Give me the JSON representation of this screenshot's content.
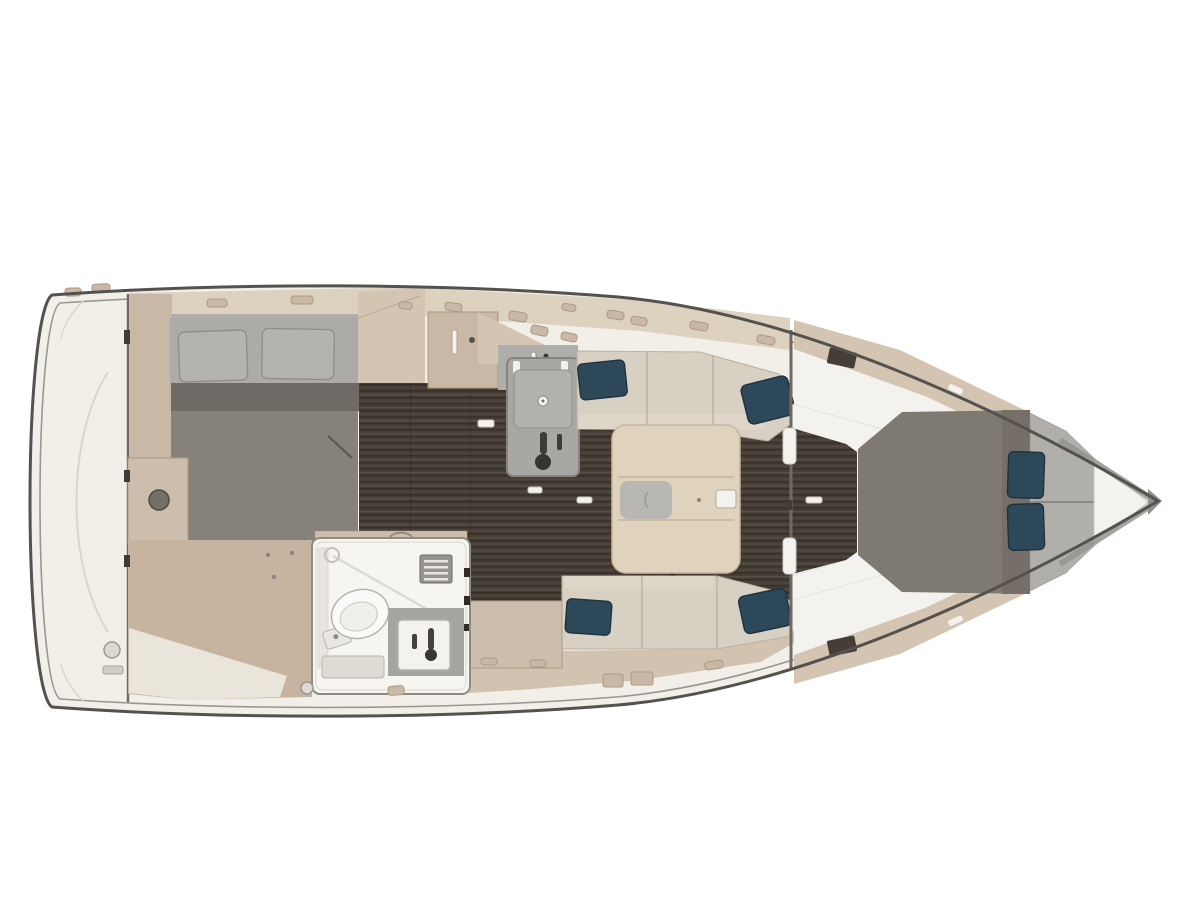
{
  "figure": {
    "kind": "yacht-interior-floor-plan",
    "view": "top-down",
    "orientation": "bow-right-stern-left",
    "visible_text": ""
  },
  "palette": {
    "page_bg": "#ffffff",
    "hull_line": "#54524e",
    "rub_line": "#9a9792",
    "deck_cream": "#f1efe8",
    "deck_line": "#d9d6cc",
    "bulkhead": "#6e6a63",
    "beige_band": "#ddd1bf",
    "beige_panel": "#c9b8a6",
    "beige_mid": "#d4c5b3",
    "beige_dark": "#ab9a83",
    "beige_floor": "#c6b4a1",
    "beige_cab": "#cdbdac",
    "beige_front": "#d2c2b0",
    "wood": "#473f36",
    "appliance": "#a9a7a3",
    "appliance_light": "#b3b1ad",
    "gray_wall": "#b0aeaa",
    "mattress": "#adaba7",
    "pillow_gray": "#b5b3b0",
    "bed_band": "#6f6b64",
    "bed_aft": "#868279",
    "bed_fore": "#7e7971",
    "bed_fore_dark": "#756f67",
    "mattress_fore": "#b1afab",
    "teal": "#2d4858",
    "teal_dark": "#1e3240",
    "sofa": "#d7d0c3",
    "sofa_line": "#b9b1a2",
    "sofa_light": "#ddd6c9",
    "table": "#e0d3bd",
    "table_line": "#c6b59c",
    "table_inset": "#b9b7b2",
    "white_room": "#f6f5f0",
    "room_line": "#8e8b85",
    "shower": "#a6a4a0",
    "white_fixture": "#f3f2ee",
    "fixture_line": "#b5b2ab",
    "hatch": "#443e36",
    "metal_dark": "#3f3c37",
    "dot": "#8b857c"
  },
  "regions": {
    "transom": "aft swim deck",
    "aft_cabin": "double berth with two gray pillows and gray duvet",
    "galley": "L-counter with gray sink-stove unit and faucet",
    "salon": "dining table with tray inset, two facing settees with teal pillows",
    "head": "bathroom with toilet, vent grill, shower sink and faucet",
    "fore_cabin": "V-berth with gray duvet, split mattress, two teal pillows",
    "anchor_locker": "white V at bow tip"
  }
}
